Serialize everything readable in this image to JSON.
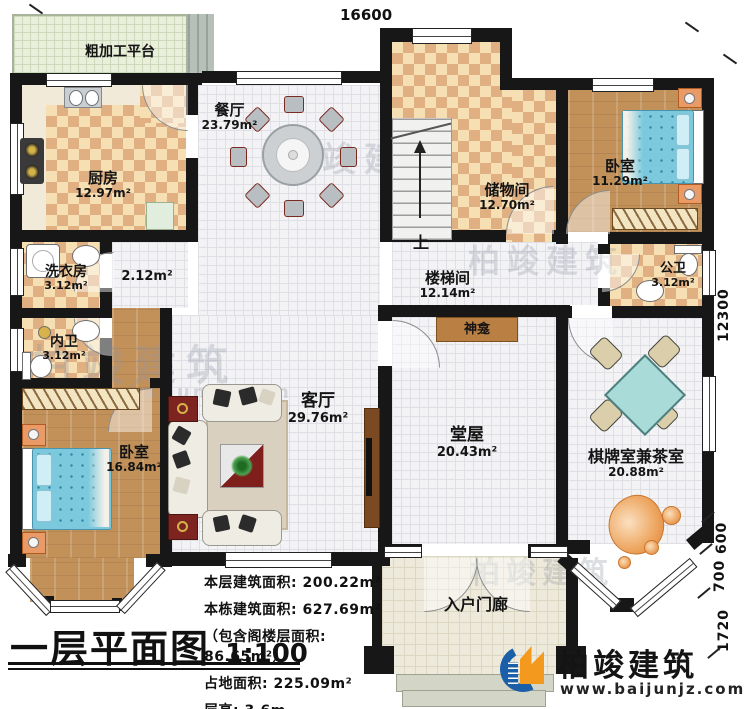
{
  "title": "一层平面图",
  "scale": "1:100",
  "stats": {
    "line1": "本层建筑面积: 200.22m²",
    "line2": "本栋建筑面积: 627.69m²",
    "line3": "（包含阁楼层面积: 86.65m²）",
    "line4": "占地面积: 225.09m²",
    "line5": "层高: 3.6m"
  },
  "rooms": {
    "platform": {
      "name": "粗加工平台"
    },
    "kitchen": {
      "name": "厨房",
      "area": "12.97m²"
    },
    "dining": {
      "name": "餐厅",
      "area": "23.79m²"
    },
    "storage": {
      "name": "储物间",
      "area": "12.70m²"
    },
    "bedroom_ne": {
      "name": "卧室",
      "area": "11.29m²"
    },
    "stair_hall": {
      "name": "楼梯间",
      "area": "12.14m²"
    },
    "public_bath": {
      "name": "公卫",
      "area": "3.12m²"
    },
    "laundry": {
      "name": "洗衣房",
      "area": "3.12m²"
    },
    "corridor": {
      "area": "2.12m²"
    },
    "private_bath": {
      "name": "内卫",
      "area": "3.12m²"
    },
    "bedroom_sw": {
      "name": "卧室",
      "area": "16.84m²"
    },
    "living": {
      "name": "客厅",
      "area": "29.76m²"
    },
    "main_hall": {
      "name": "堂屋",
      "area": "20.43m²"
    },
    "chess_tea": {
      "name": "棋牌室兼茶室",
      "area": "20.88m²"
    },
    "porch": {
      "name": "入户门廊"
    }
  },
  "annotations": {
    "shrine": "神龛",
    "stairs_up": "上"
  },
  "dimensions": {
    "top_width": "16600",
    "right_height": "12300",
    "right_d600": "600",
    "right_d700": "700",
    "right_d1720": "1720"
  },
  "branding": {
    "company": "柏竣建筑",
    "website": "www.baijunjz.com"
  },
  "watermark": {
    "company": "柏竣建筑",
    "website": "www.baijunjz.com"
  },
  "colors": {
    "wall": "#171717",
    "checker_light": "#f6dfb2",
    "checker_dark": "#e0b083",
    "wood_floor": "#c2915a",
    "tile_floor": "#f3f3f6",
    "bed_blue": "#7cc9de",
    "mahjong_table": "#a9dbd8",
    "logo_blue": "#1a5fa8",
    "logo_orange": "#f39a1e"
  }
}
